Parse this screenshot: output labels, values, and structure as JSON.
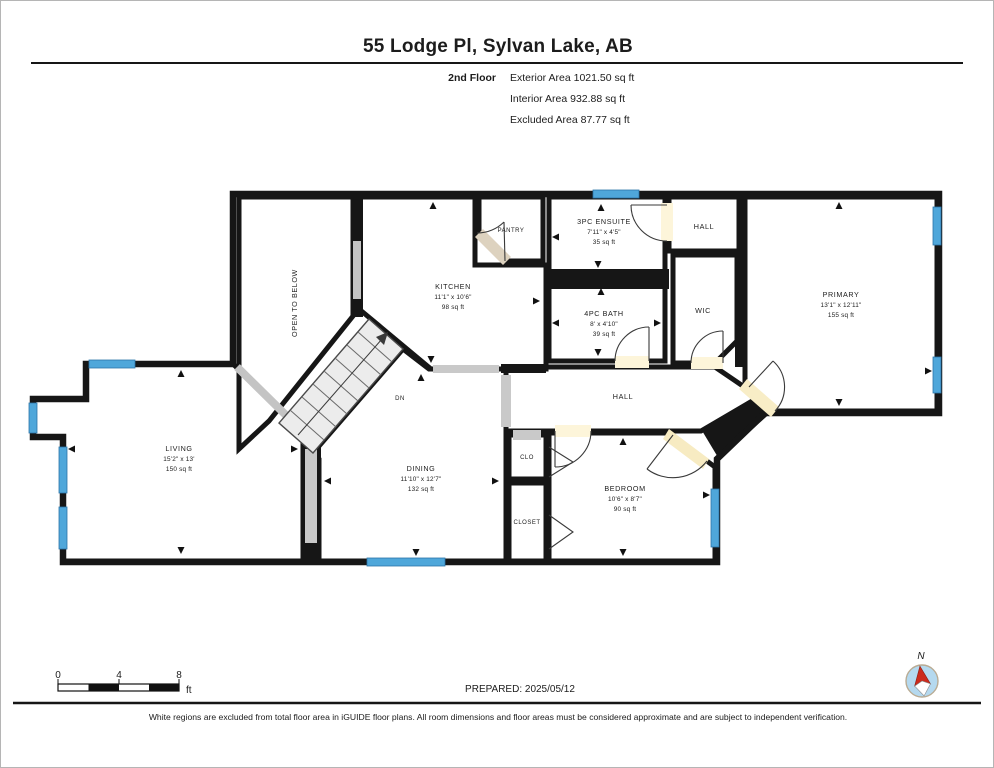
{
  "header": {
    "title": "55 Lodge Pl, Sylvan Lake, AB",
    "floor": "2nd Floor",
    "exterior": "Exterior Area 1021.50 sq ft",
    "interior": "Interior Area 932.88 sq ft",
    "excluded": "Excluded Area 87.77 sq ft"
  },
  "rooms": {
    "open_to_below": {
      "name": "OPEN TO BELOW"
    },
    "kitchen": {
      "name": "KITCHEN",
      "dims": "11'1\" x 10'6\"",
      "area": "98 sq ft"
    },
    "pantry": {
      "name": "PANTRY"
    },
    "ensuite": {
      "name": "3PC ENSUITE",
      "dims": "7'11\" x 4'5\"",
      "area": "35 sq ft"
    },
    "hall_upper": {
      "name": "HALL"
    },
    "wic": {
      "name": "WIC"
    },
    "bath": {
      "name": "4PC BATH",
      "dims": "8' x 4'10\"",
      "area": "39 sq ft"
    },
    "primary": {
      "name": "PRIMARY",
      "dims": "13'1\" x 12'11\"",
      "area": "155 sq ft"
    },
    "hall": {
      "name": "HALL"
    },
    "living": {
      "name": "LIVING",
      "dims": "15'2\" x 13'",
      "area": "150 sq ft"
    },
    "dining": {
      "name": "DINING",
      "dims": "11'10\" x 12'7\"",
      "area": "132 sq ft"
    },
    "clo": {
      "name": "CLO"
    },
    "closet": {
      "name": "CLOSET"
    },
    "bedroom": {
      "name": "BEDROOM",
      "dims": "10'6\" x 8'7\"",
      "area": "90 sq ft"
    },
    "stairs": {
      "label": "DN"
    }
  },
  "footer": {
    "scale_ticks": [
      "0",
      "4",
      "8"
    ],
    "scale_unit": "ft",
    "prepared": "PREPARED: 2025/05/12",
    "compass": "N",
    "disclaimer": "White regions are excluded from total floor area in iGUIDE floor plans. All room dimensions and floor areas must be considered approximate and are subject to independent verification."
  },
  "colors": {
    "wall": "#161616",
    "window": "#4fa7da",
    "bath_fill": "#abd9f2",
    "kitchen_fill": "#e4efe8",
    "tan_fill": "#e0d5c2",
    "cream_fill": "#fdf5da",
    "yellow_fill": "#f8edc5",
    "dining_fill": "#e2dccd",
    "opening_gray": "#c9c9c9"
  }
}
